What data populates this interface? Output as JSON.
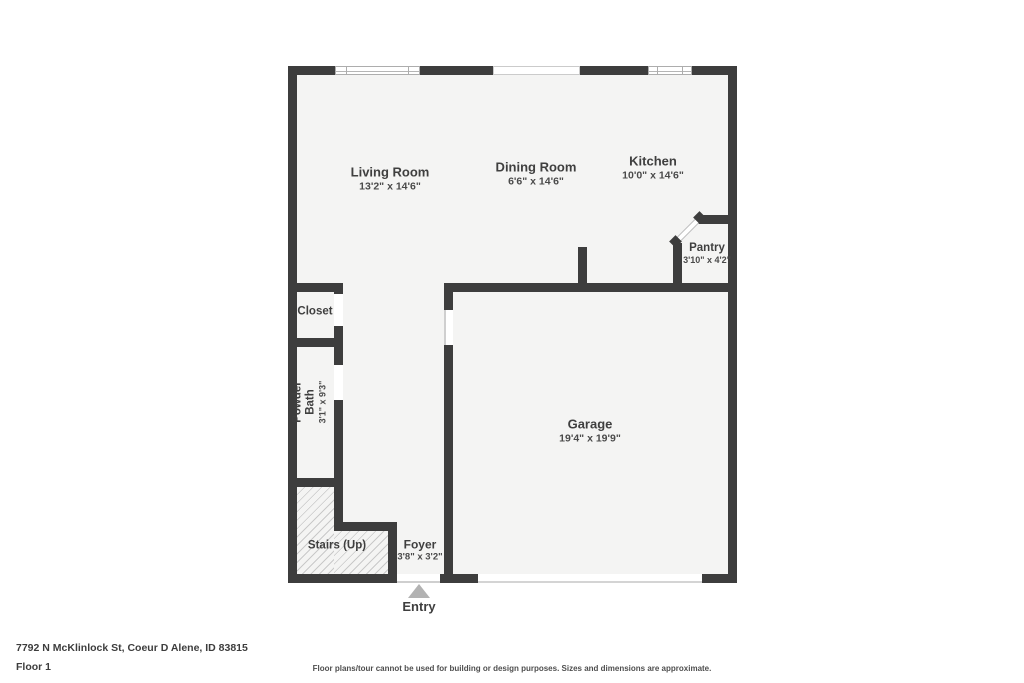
{
  "title": "Floor plan - Floor 1",
  "colors": {
    "wall": "#3d3d3d",
    "floor": "#f4f4f3",
    "hatch_line": "#c9c9c9",
    "window_frame": "#adadad",
    "entry_arrow": "#b2b2b2",
    "text": "#3f3f3f"
  },
  "floorplan": {
    "rooms": {
      "living": {
        "name": "Living Room",
        "dims": "13'2\" x 14'6\""
      },
      "dining": {
        "name": "Dining Room",
        "dims": "6'6\" x 14'6\""
      },
      "kitchen": {
        "name": "Kitchen",
        "dims": "10'0\" x 14'6\""
      },
      "pantry": {
        "name": "Pantry",
        "dims": "3'10\" x 4'2\""
      },
      "closet": {
        "name": "Closet"
      },
      "powder_bath": {
        "name_lines": [
          "Powder",
          "Bath"
        ],
        "dims": "3'1\" x 9'3\""
      },
      "stairs": {
        "name": "Stairs (Up)"
      },
      "foyer": {
        "name": "Foyer",
        "dims": "3'8\" x 3'2\""
      },
      "garage": {
        "name": "Garage",
        "dims": "19'4\" x 19'9\""
      }
    },
    "entry_label": "Entry"
  },
  "footer": {
    "address": "7792 N McKlinlock St, Coeur D Alene, ID 83815",
    "floor_label": "Floor 1",
    "disclaimer": "Floor plans/tour cannot be used for building or design purposes. Sizes and dimensions are approximate."
  }
}
